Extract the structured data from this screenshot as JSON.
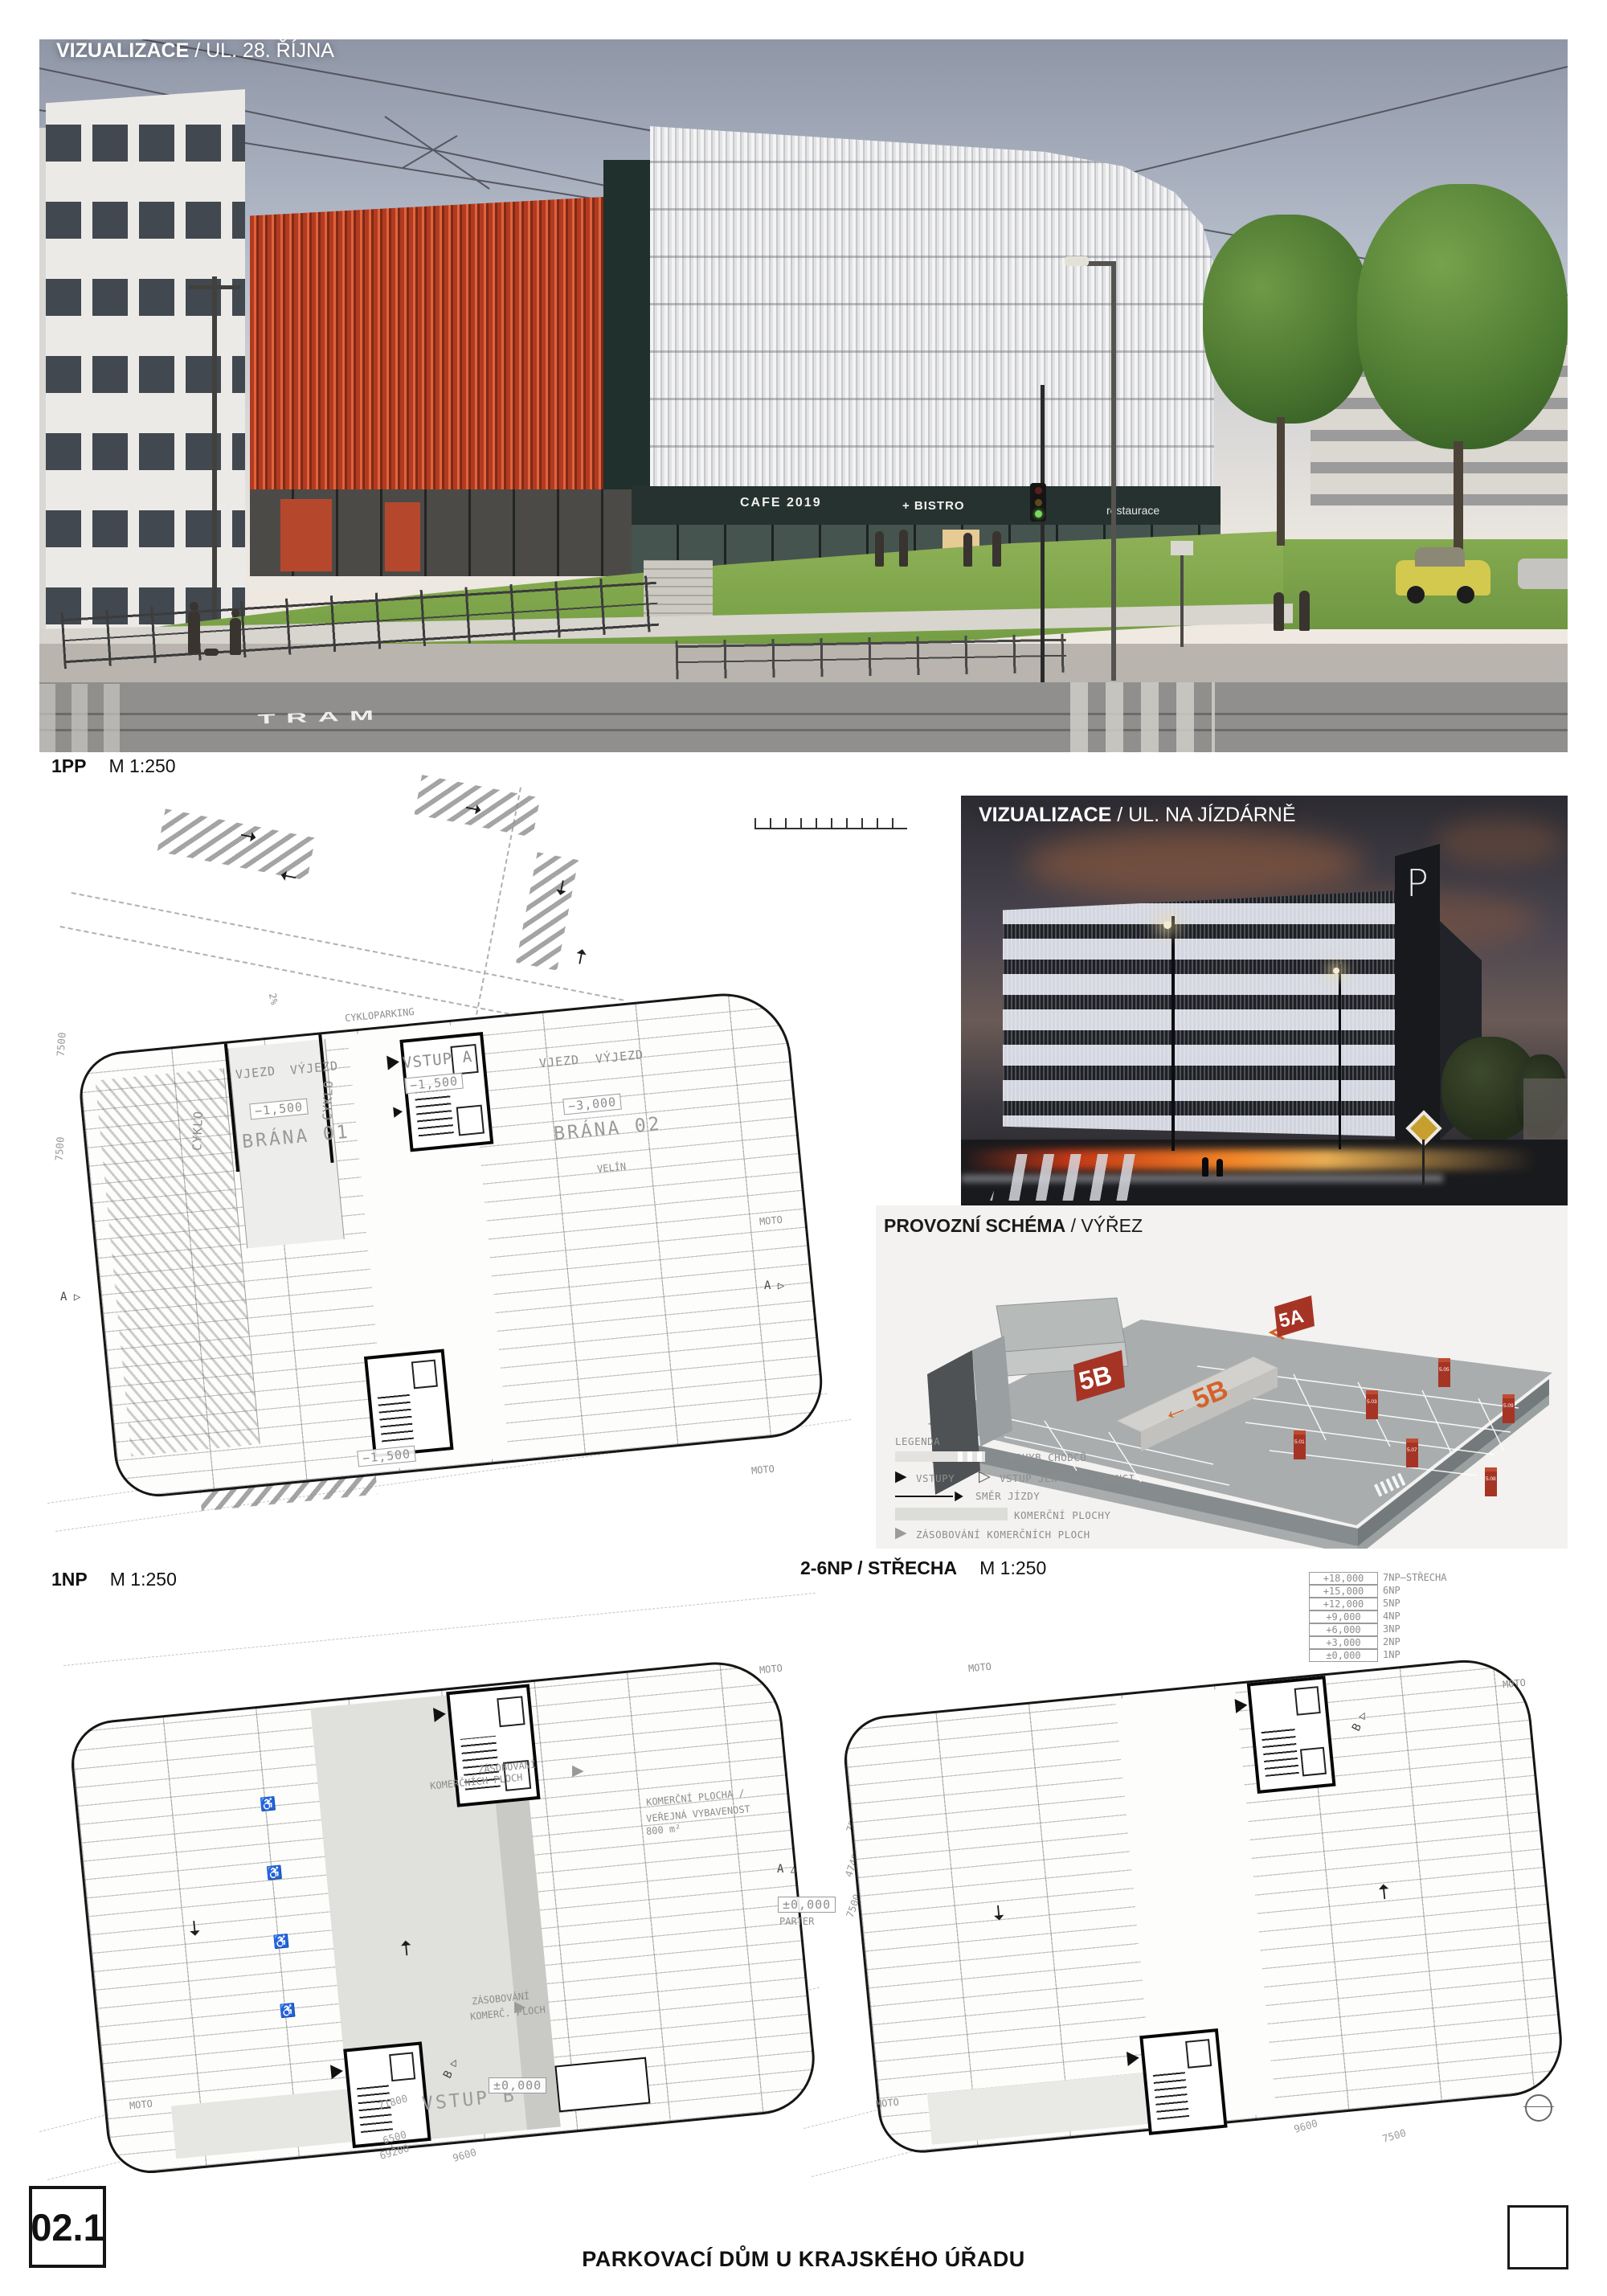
{
  "board": {
    "panel_number": "02.1",
    "title": "PARKOVACÍ DŮM U KRAJSKÉHO ÚŘADU"
  },
  "colors": {
    "facade_red": "#c2472a",
    "schema_red": "#a63425",
    "ramp_orange": "#d4622a",
    "night_cloud": "#b06a40"
  },
  "viz_street": {
    "label_bold": "VIZUALIZACE",
    "label_rest": " / UL. 28. ŘÍJNA",
    "sign_cafe": "CAFE 2019",
    "sign_bistro": "+ BISTRO",
    "sign_restaurace": "restaurace",
    "road_marking": "TRAM"
  },
  "plan_1pp": {
    "name": "1PP",
    "scale": "M 1:250",
    "labels": {
      "vstup_a": "VSTUP A",
      "brana_01": "BRÁNA 01",
      "brana_02": "BRÁNA 02",
      "vjezd": "VJEZD",
      "vyjezd": "VÝJEZD",
      "velin": "VELÍN",
      "cyklo": "CYKLO",
      "cykloparking": "CYKLOPARKING",
      "moto": "MOTO",
      "level_m1500": "−1,500",
      "level_m3000": "−3,000",
      "slope": "2%",
      "section_a": "A"
    },
    "dims": {
      "d7500": "7500"
    }
  },
  "viz_night": {
    "label_bold": "VIZUALIZACE",
    "label_rest": " / UL. NA JÍZDÁRNĚ",
    "tower_sign": "P"
  },
  "schema": {
    "label_bold": "PROVOZNÍ SCHÉMA",
    "label_rest": " / VÝŘEZ",
    "marker_5a": "5A",
    "marker_5b": "5B",
    "ramp_label": "← 5B",
    "pillars": [
      "5.01",
      "5.03",
      "5.05",
      "5.07",
      "5.08",
      "5.09"
    ],
    "legend": {
      "title": "LEGENDA",
      "items": [
        {
          "text": "POHYB CHODCŮ"
        },
        {
          "text": "VSTUPY"
        },
        {
          "text": "VSTUP JEN ZAMĚSTNANCI"
        },
        {
          "text": "SMĚR JÍZDY"
        },
        {
          "text": "KOMERČNÍ PLOCHY"
        },
        {
          "text": "ZÁSOBOVÁNÍ KOMERČNÍCH PLOCH"
        }
      ]
    }
  },
  "plan_1np": {
    "name": "1NP",
    "scale": "M 1:250",
    "labels": {
      "vstup_b": "VSTUP B",
      "moto": "MOTO",
      "komercni_1": "KOMERČNÍ PLOCHA /",
      "komercni_2": "VEŘEJNÁ VYBAVENOST",
      "komercni_3": "800 m²",
      "zas_top_1": "ZÁSOBOVÁNÍ",
      "zas_top_2": "KOMERČNÍCH PLOCH",
      "zas_bot_1": "ZÁSOBOVÁNÍ",
      "zas_bot_2": "KOMERČ. PLOCH",
      "level_0": "±0,000",
      "parter": "PARTER",
      "section_a": "A",
      "section_b": "B"
    },
    "dims": {
      "d71800": "71800",
      "d6500": "6500",
      "d69200": "69200",
      "d9600": "9600",
      "d47400": "47400",
      "d7500": "7500"
    }
  },
  "plan_26np": {
    "name": "2-6NP / STŘECHA",
    "scale": "M 1:250",
    "labels": {
      "moto": "MOTO",
      "section_b": "B"
    },
    "dims": {
      "d9600": "9600",
      "d7500": "7500"
    },
    "elevations": [
      {
        "value": "+18,000",
        "name": "7NP–STŘECHA"
      },
      {
        "value": "+15,000",
        "name": "6NP"
      },
      {
        "value": "+12,000",
        "name": "5NP"
      },
      {
        "value": "+9,000",
        "name": "4NP"
      },
      {
        "value": "+6,000",
        "name": "3NP"
      },
      {
        "value": "+3,000",
        "name": "2NP"
      },
      {
        "value": "±0,000",
        "name": "1NP"
      }
    ]
  }
}
